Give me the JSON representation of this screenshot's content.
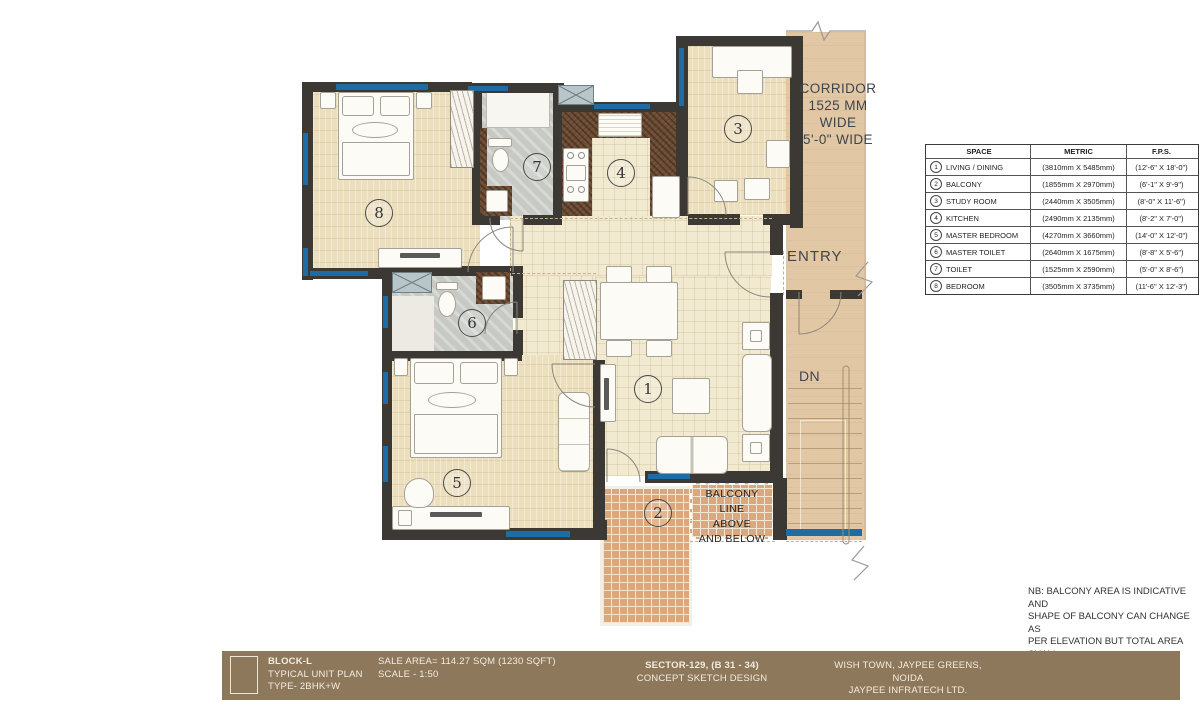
{
  "colors": {
    "wall": "#3c3834",
    "window_blue": "#1d6ca6",
    "floor_cream": "#f1e9d0",
    "floor_bedroom": "#ecdfbd",
    "tile_gray": "#c6c9c4",
    "counter_brown": "#6e4c34",
    "corridor_tan": "#e2c7a4",
    "balcony_brick": "#d9a87e",
    "titlebar_brown": "#8e785c"
  },
  "plan": {
    "rooms": [
      {
        "num": "1"
      },
      {
        "num": "2"
      },
      {
        "num": "3"
      },
      {
        "num": "4"
      },
      {
        "num": "5"
      },
      {
        "num": "6"
      },
      {
        "num": "7"
      },
      {
        "num": "8"
      }
    ],
    "corridor": [
      "CORRIDOR",
      "1525 MM",
      "WIDE",
      "5'-0\" WIDE"
    ],
    "entry": "ENTRY",
    "dn": "DN",
    "balcony_line": [
      "BALCONY LINE",
      "ABOVE",
      "AND BELOW"
    ]
  },
  "legend_table": {
    "headers": [
      "SPACE",
      "METRIC",
      "F.P.S."
    ],
    "rows": [
      {
        "num": "1",
        "space": "LIVING / DINING",
        "metric": "(3810mm X 5485mm)",
        "fps": "(12'-6\" X 18'-0\")"
      },
      {
        "num": "2",
        "space": "BALCONY",
        "metric": "(1855mm X 2970mm)",
        "fps": "(6'-1\" X 9'-9\")"
      },
      {
        "num": "3",
        "space": "STUDY ROOM",
        "metric": "(2440mm X 3505mm)",
        "fps": "(8'-0\" X 11'-6\")"
      },
      {
        "num": "4",
        "space": "KITCHEN",
        "metric": "(2490mm X 2135mm)",
        "fps": "(8'-2\" X 7'-0\")"
      },
      {
        "num": "5",
        "space": "MASTER BEDROOM",
        "metric": "(4270mm X 3660mm)",
        "fps": "(14'-0\" X 12'-0\")"
      },
      {
        "num": "6",
        "space": "MASTER TOILET",
        "metric": "(2640mm X 1675mm)",
        "fps": "(8'-8\" X 5'-6\")"
      },
      {
        "num": "7",
        "space": "TOILET",
        "metric": "(1525mm X 2590mm)",
        "fps": "(5'-0\" X 8'-6\")"
      },
      {
        "num": "8",
        "space": "BEDROOM",
        "metric": "(3505mm X 3735mm)",
        "fps": "(11'-6\" X 12'-3\")"
      }
    ]
  },
  "note": {
    "lines": [
      "NB: BALCONY AREA IS INDICATIVE AND",
      "SHAPE OF BALCONY CAN CHANGE AS",
      "PER ELEVATION BUT TOTAL AREA SHALL",
      "BE SAME"
    ]
  },
  "titlebar": {
    "block": [
      "BLOCK-L",
      "TYPICAL UNIT PLAN",
      "TYPE- 2BHK+W"
    ],
    "area": [
      "SALE AREA= 114.27 SQM (1230 SQFT)",
      "SCALE - 1:50"
    ],
    "sector": [
      "SECTOR-129, (B 31 - 34)",
      "CONCEPT SKETCH DESIGN"
    ],
    "company": [
      "WISH TOWN, JAYPEE GREENS, NOIDA",
      "JAYPEE INFRATECH LTD."
    ]
  }
}
